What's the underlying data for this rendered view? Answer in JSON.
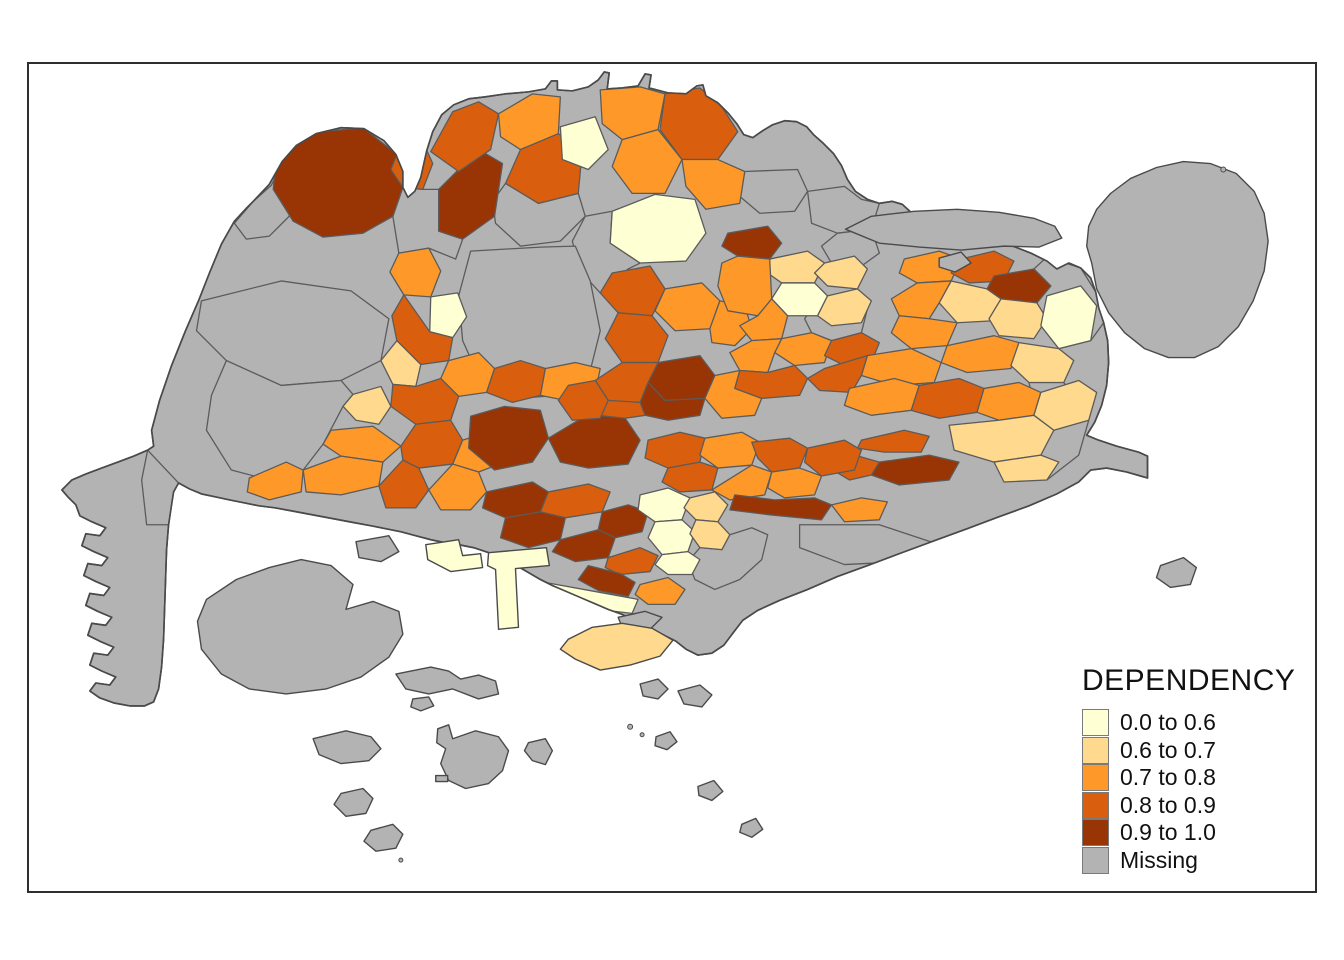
{
  "legend": {
    "title": "DEPENDENCY",
    "items": [
      {
        "label": "0.0 to 0.6",
        "key": "c0",
        "color": "#FFFFD4"
      },
      {
        "label": "0.6 to 0.7",
        "key": "c1",
        "color": "#FED98E"
      },
      {
        "label": "0.7 to 0.8",
        "key": "c2",
        "color": "#FE9929"
      },
      {
        "label": "0.8 to 0.9",
        "key": "c3",
        "color": "#D95F0E"
      },
      {
        "label": "0.9 to 1.0",
        "key": "c4",
        "color": "#993404"
      },
      {
        "label": "Missing",
        "key": "missing",
        "color": "#B3B3B3"
      }
    ]
  },
  "map": {
    "view_box": "27 62 1290 831",
    "colors": {
      "c0": "#FFFFD4",
      "c1": "#FED98E",
      "c2": "#FE9929",
      "c3": "#D95F0E",
      "c4": "#993404",
      "missing": "#B3B3B3",
      "border": "#5B5B5B",
      "coast": "#4A4A4A",
      "water": "#FFFFFF"
    },
    "main_island": "252,200 268,183 281,160 295,144 315,132 340,126 363,127 383,139 395,153 402,170 402,186 407,196 414,190 420,176 426,149 432,130 441,113 453,103 468,97 485,95 505,92 528,90 545,87 551,79 557,79 557,88 572,89 588,85 598,78 604,70 609,71 607,87 622,86 638,84 645,72 651,73 649,86 668,91 686,92 697,84 703,83 706,94 718,101 728,111 737,122 744,133 753,136 763,129 773,123 785,119 797,120 807,125 814,133 823,141 834,152 842,164 848,178 856,190 868,198 880,202 893,200 903,203 916,215 930,222 946,227 962,232 978,236 996,240 1014,245 1032,252 1048,260 1058,268 1070,262 1082,267 1092,277 1097,291 1100,307 1105,322 1109,340 1110,362 1108,385 1103,405 1096,422 1088,435 1100,440 1118,446 1140,452 1149,456 1149,478 1128,472 1108,468 1092,470 1080,482 1058,494 1030,506 1000,517 968,529 935,541 900,554 868,566 838,577 808,590 780,601 758,611 743,621 733,634 724,646 712,654 698,656 686,650 676,642 662,635 650,629 636,622 622,615 608,610 594,604 580,598 566,592 552,586 540,580 528,573 516,566 502,559 488,553 473,548 458,545 444,543 430,540 415,536 400,532 385,529 370,526 354,523 338,520 322,517 306,514 290,511 274,508 258,506 243,503 228,500 214,497 200,494 188,489 177,483 172,492 170,505 167,525 165,550 164,580 163,610 162,640 160,668 157,690 152,703 143,707 128,707 112,704 98,699 88,692 94,684 108,686 114,678 100,672 88,666 92,654 106,656 112,648 98,642 86,636 90,624 104,626 110,618 96,612 84,606 88,594 102,596 108,588 94,582 82,576 86,564 100,566 106,558 92,552 80,546 84,534 98,536 104,528 90,522 78,516 74,505 66,497 60,490 70,480 84,474 100,468 116,462 132,456 146,450 152,446 150,430 158,400 170,365 184,330 197,300 208,272 220,243 233,220 245,207",
    "zones": [
      {
        "k": "missing",
        "p": "200,300 280,280 350,290 388,318 380,360 340,380 280,385 225,360 195,330"
      },
      {
        "k": "missing",
        "p": "225,360 280,385 340,380 352,394 342,406 322,444 302,470 268,480 230,470 205,430 210,395"
      },
      {
        "k": "missing",
        "p": "233,222 252,200 270,184 281,162 292,175 288,215 268,235 245,238"
      },
      {
        "k": "missing",
        "p": "392,215 402,186 422,188 438,188 438,230 462,238 455,258 428,247 398,252"
      },
      {
        "k": "missing",
        "p": "505,182 538,202 578,192 585,215 560,240 520,245 495,222 492,200"
      },
      {
        "k": "missing",
        "p": "585,215 612,210 610,242 640,262 628,268 600,292 580,270 572,240"
      },
      {
        "k": "missing",
        "p": "470,250 540,246 575,245 590,280 600,330 590,370 560,395 515,398 480,380 462,340 458,295"
      },
      {
        "k": "missing",
        "p": "745,170 798,168 808,190 795,210 760,212 740,195"
      },
      {
        "k": "missing",
        "p": "808,190 845,185 862,198 880,202 872,228 838,232 812,222"
      },
      {
        "k": "missing",
        "p": "838,232 872,228 880,252 858,268 832,262 822,245"
      },
      {
        "k": "missing",
        "p": "815,305 848,298 868,308 862,332 832,340 812,332 805,318"
      },
      {
        "k": "missing",
        "p": "1048,256 1082,267 1097,291 1105,322 1092,340 1060,348 1042,325 1038,302 1052,285 1035,268"
      },
      {
        "k": "missing",
        "p": "1065,382 1090,420 1080,455 1048,480 1030,470 1042,430 1030,382"
      },
      {
        "k": "missing",
        "p": "700,548 722,550 730,535 752,528 768,535 762,560 740,580 715,590 695,580 688,562"
      },
      {
        "k": "missing",
        "p": "800,525 880,525 940,545 905,562 845,565 800,548"
      },
      {
        "k": "missing",
        "p": "146,450 177,483 172,492 167,525 145,525 140,480"
      },
      {
        "k": "c4",
        "p": "275,152 310,131 362,126 395,152 402,186 392,215 362,232 322,236 292,220 272,188"
      },
      {
        "k": "c3",
        "p": "398,148 422,140 432,162 422,188 402,186 390,168"
      },
      {
        "k": "c4",
        "p": "438,188 478,148 502,162 494,215 462,238 438,230"
      },
      {
        "k": "c3",
        "p": "430,150 452,110 478,100 498,112 490,148 458,170"
      },
      {
        "k": "c2",
        "p": "498,112 532,92 560,95 558,132 520,148 500,135"
      },
      {
        "k": "c3",
        "p": "520,148 558,132 582,148 578,192 538,202 505,182"
      },
      {
        "k": "c0",
        "p": "560,125 595,115 608,148 588,168 562,158"
      },
      {
        "k": "c2",
        "p": "600,88 640,85 665,92 658,128 622,138 602,122"
      },
      {
        "k": "c3",
        "p": "665,92 700,86 722,105 738,130 718,158 682,158 660,128"
      },
      {
        "k": "c2",
        "p": "622,138 658,128 682,158 665,192 632,192 612,165"
      },
      {
        "k": "c0",
        "p": "612,210 655,193 695,198 706,232 686,260 640,262 610,242"
      },
      {
        "k": "c2",
        "p": "682,158 718,158 745,170 740,202 706,208 686,185"
      },
      {
        "k": "c2",
        "p": "398,252 428,247 440,270 430,296 403,294 389,271"
      },
      {
        "k": "c0",
        "p": "430,296 457,292 466,316 452,337 429,331"
      },
      {
        "k": "c3",
        "p": "403,294 429,331 452,337 448,360 420,364 396,340 391,315"
      },
      {
        "k": "c1",
        "p": "396,340 420,364 415,386 392,384 380,360"
      },
      {
        "k": "c2",
        "p": "448,360 478,352 494,368 486,392 458,396 440,378"
      },
      {
        "k": "c3",
        "p": "392,384 415,386 440,378 458,396 450,420 415,424 390,406"
      },
      {
        "k": "c1",
        "p": "352,394 380,386 390,406 378,424 355,420 342,406"
      },
      {
        "k": "c2",
        "p": "330,430 372,426 400,446 382,462 340,456 322,444"
      },
      {
        "k": "c3",
        "p": "400,446 415,424 450,420 462,440 452,464 418,468 402,460"
      },
      {
        "k": "c2",
        "p": "452,464 462,440 488,432 508,440 504,462 478,472"
      },
      {
        "k": "c2",
        "p": "248,478 285,462 302,470 300,492 268,500 246,492"
      },
      {
        "k": "c2",
        "p": "302,470 340,456 382,462 378,486 340,495 305,492"
      },
      {
        "k": "c3",
        "p": "378,486 402,460 418,468 428,490 415,508 385,508"
      },
      {
        "k": "c2",
        "p": "428,490 452,464 478,472 486,492 470,510 440,510"
      },
      {
        "k": "c3",
        "p": "486,392 494,368 520,360 545,368 540,395 512,402"
      },
      {
        "k": "c2",
        "p": "540,395 545,368 575,362 600,368 595,392 565,400"
      },
      {
        "k": "c4",
        "p": "470,416 504,406 540,410 548,438 532,462 494,470 468,448"
      },
      {
        "k": "c4",
        "p": "548,438 588,414 625,418 640,440 628,464 588,468 560,462"
      },
      {
        "k": "c3",
        "p": "595,392 625,388 648,396 645,415 625,418 588,414 585,400"
      },
      {
        "k": "c4",
        "p": "486,492 532,482 548,492 540,512 505,518 482,508"
      },
      {
        "k": "c3",
        "p": "548,492 588,484 610,492 602,512 565,518 540,512"
      },
      {
        "k": "c4",
        "p": "505,518 540,512 565,518 560,540 528,548 500,538"
      },
      {
        "k": "c4",
        "p": "602,512 628,505 648,512 642,532 615,538 598,530"
      },
      {
        "k": "c4",
        "p": "560,540 598,530 615,538 608,558 575,562 552,552"
      },
      {
        "k": "c3",
        "p": "608,558 640,548 658,556 650,572 620,575 605,568"
      },
      {
        "k": "c3",
        "p": "612,272 650,265 665,288 652,315 618,312 600,292"
      },
      {
        "k": "c2",
        "p": "665,288 702,282 720,300 710,328 675,330 655,310"
      },
      {
        "k": "c2",
        "p": "710,328 720,300 745,305 752,328 735,345 712,342"
      },
      {
        "k": "c3",
        "p": "618,312 652,315 668,335 658,362 622,362 605,338"
      },
      {
        "k": "c4",
        "p": "658,362 700,355 715,375 705,398 665,400 648,382"
      },
      {
        "k": "c3",
        "p": "622,362 658,362 648,382 640,402 608,400 595,380"
      },
      {
        "k": "c4",
        "p": "640,402 648,382 665,400 705,398 700,415 668,420 645,415"
      },
      {
        "k": "c3",
        "p": "595,380 608,400 600,418 572,420 558,400 568,385"
      },
      {
        "k": "c2",
        "p": "715,375 740,370 735,388 762,398 755,415 722,418 705,398"
      },
      {
        "k": "c4",
        "p": "728,232 768,225 782,242 770,258 738,255 722,245"
      },
      {
        "k": "c1",
        "p": "770,258 808,250 825,262 815,282 782,282 765,270"
      },
      {
        "k": "c0",
        "p": "782,282 815,282 828,295 818,315 788,315 772,298"
      },
      {
        "k": "c1",
        "p": "825,262 855,255 868,268 858,288 828,285 815,272"
      },
      {
        "k": "c2",
        "p": "738,255 770,258 772,298 758,315 728,310 718,285 722,262"
      },
      {
        "k": "c2",
        "p": "758,315 772,298 788,315 782,338 752,340 740,325"
      },
      {
        "k": "c1",
        "p": "818,315 828,295 858,288 872,300 862,322 832,325"
      },
      {
        "k": "c2",
        "p": "782,338 812,332 832,340 825,362 795,365 775,352"
      },
      {
        "k": "c2",
        "p": "752,340 782,338 775,352 768,372 740,370 730,352"
      },
      {
        "k": "c3",
        "p": "832,340 862,332 880,342 872,362 845,365 825,355"
      },
      {
        "k": "c3",
        "p": "740,370 768,372 795,365 808,378 800,395 762,398 735,388"
      },
      {
        "k": "c2",
        "p": "905,258 940,250 962,258 952,280 918,282 900,272"
      },
      {
        "k": "c3",
        "p": "962,258 995,250 1015,260 1005,280 970,282 952,272"
      },
      {
        "k": "c1",
        "p": "952,280 988,288 1002,298 995,320 958,322 940,302"
      },
      {
        "k": "c4",
        "p": "995,275 1035,268 1052,285 1038,302 1002,298 988,288"
      },
      {
        "k": "c1",
        "p": "1002,298 1038,302 1048,318 1035,338 1000,335 990,318"
      },
      {
        "k": "c0",
        "p": "1048,295 1082,285 1098,305 1092,340 1060,348 1042,325"
      },
      {
        "k": "c2",
        "p": "918,282 952,280 940,302 930,318 900,315 892,298"
      },
      {
        "k": "c2",
        "p": "900,315 930,318 958,322 948,345 912,348 892,332"
      },
      {
        "k": "c2",
        "p": "948,345 995,335 1020,342 1012,368 968,372 942,362"
      },
      {
        "k": "c1",
        "p": "1020,342 1060,348 1075,360 1065,382 1030,382 1012,365"
      },
      {
        "k": "c2",
        "p": "868,355 912,348 942,362 935,382 895,385 862,375"
      },
      {
        "k": "c3",
        "p": "825,368 868,355 862,375 852,392 820,390 808,378"
      },
      {
        "k": "c2",
        "p": "850,388 895,378 920,385 912,410 872,415 845,405"
      },
      {
        "k": "c3",
        "p": "920,385 960,378 985,388 978,412 940,418 912,410"
      },
      {
        "k": "c2",
        "p": "985,388 1020,382 1042,392 1035,415 1000,420 978,412"
      },
      {
        "k": "c1",
        "p": "1042,392 1080,380 1098,392 1090,420 1055,430 1035,415"
      },
      {
        "k": "c1",
        "p": "950,425 1000,420 1035,415 1055,430 1042,455 995,462 955,450"
      },
      {
        "k": "c3",
        "p": "862,440 905,430 930,436 922,452 885,452 858,448"
      },
      {
        "k": "c4",
        "p": "880,462 930,455 960,462 950,480 900,485 872,475"
      },
      {
        "k": "c3",
        "p": "845,452 880,462 872,475 850,480 830,468 828,455"
      },
      {
        "k": "c1",
        "p": "995,462 1042,455 1060,462 1048,480 1005,482"
      },
      {
        "k": "c3",
        "p": "648,440 680,432 705,438 700,462 668,468 645,458"
      },
      {
        "k": "c2",
        "p": "705,438 742,432 760,442 752,465 718,468 700,455"
      },
      {
        "k": "c3",
        "p": "668,468 700,462 718,468 712,490 680,492 662,482"
      },
      {
        "k": "c2",
        "p": "712,490 752,465 772,472 765,495 730,500"
      },
      {
        "k": "c3",
        "p": "752,442 790,438 808,448 800,468 772,472 758,458"
      },
      {
        "k": "c2",
        "p": "772,472 800,468 822,476 815,495 785,498 768,488"
      },
      {
        "k": "c3",
        "p": "808,448 845,440 862,450 855,470 822,476 805,462"
      },
      {
        "k": "c4",
        "p": "735,495 775,500 815,498 832,505 822,520 770,515 730,510"
      },
      {
        "k": "c2",
        "p": "832,505 862,498 888,502 880,520 845,522"
      },
      {
        "k": "c0",
        "p": "640,495 668,488 690,498 682,520 655,522 638,510"
      },
      {
        "k": "c1",
        "p": "690,498 715,492 728,505 718,522 696,520 684,508"
      },
      {
        "k": "c0",
        "p": "655,522 682,520 695,532 688,552 662,555 648,538"
      },
      {
        "k": "c1",
        "p": "696,520 718,522 730,535 722,550 700,548 690,534"
      },
      {
        "k": "c0",
        "p": "662,555 688,552 700,560 692,575 668,575 655,565"
      },
      {
        "k": "c0",
        "p": "545,583 600,593 638,600 632,614 580,608 543,598"
      },
      {
        "k": "c4",
        "p": "588,566 620,574 635,583 628,597 598,591 578,580"
      },
      {
        "k": "c2",
        "p": "640,585 668,578 685,590 675,605 648,605 635,595"
      }
    ],
    "islands": [
      {
        "name": "jurong-island",
        "k": "missing",
        "p": "205,600 235,580 268,568 300,560 330,566 352,585 345,610 372,602 398,612 402,635 388,658 360,678 325,690 285,695 248,690 220,675 200,650 196,622"
      },
      {
        "name": "jurong-islet",
        "k": "missing",
        "p": "355,542 388,536 398,552 380,562 358,558"
      },
      {
        "name": "brani",
        "k": "missing",
        "p": "618,618 645,612 662,618 650,630 622,628"
      },
      {
        "name": "ubin",
        "k": "missing",
        "p": "846,228 872,215 915,210 958,208 1000,211 1035,217 1056,225 1063,237 1040,246 1005,245 962,249 920,246 880,242"
      },
      {
        "name": "ketam",
        "k": "missing",
        "p": "940,257 962,251 972,262 956,271 940,266"
      },
      {
        "name": "tekong",
        "k": "missing",
        "p": "1093,262 1088,245 1090,225 1098,208 1112,192 1132,177 1158,166 1185,160 1212,162 1238,172 1256,190 1266,212 1270,240 1266,270 1255,300 1240,326 1220,346 1196,357 1170,357 1146,348 1126,332 1110,312 1098,288"
      },
      {
        "name": "se-islet",
        "k": "missing",
        "p": "1162,566 1185,558 1198,568 1192,585 1172,588 1158,578"
      },
      {
        "name": "south-island",
        "k": "missing",
        "p": "395,675 430,668 448,672 460,680 478,676 495,682 498,695 478,700 452,690 428,695 405,690"
      },
      {
        "name": "south-island",
        "k": "missing",
        "p": "412,700 428,698 433,707 420,712 410,708"
      },
      {
        "name": "south-island",
        "k": "missing",
        "p": "312,740 345,732 370,738 380,750 368,762 340,765 318,756"
      },
      {
        "name": "south-island",
        "k": "missing",
        "p": "437,730 448,726 452,740 475,732 498,738 508,752 502,772 488,785 465,790 448,782 440,765 445,750 436,744"
      },
      {
        "name": "south-island",
        "k": "missing",
        "p": "528,744 545,740 552,752 545,766 532,762 524,752"
      },
      {
        "name": "south-island",
        "k": "missing",
        "p": "340,795 362,790 372,800 365,815 345,818 333,806"
      },
      {
        "name": "south-island",
        "k": "missing",
        "p": "370,832 392,826 402,836 395,850 375,853 363,843"
      },
      {
        "name": "south-island",
        "k": "missing",
        "p": "435,777 447,777 447,783 435,783"
      },
      {
        "name": "south-island",
        "k": "missing",
        "p": "640,685 658,680 668,690 658,700 643,697"
      },
      {
        "name": "south-island",
        "k": "missing",
        "p": "678,692 700,686 712,696 702,708 684,705"
      },
      {
        "name": "south-island",
        "k": "missing",
        "p": "656,738 670,733 677,743 667,751 655,747"
      },
      {
        "name": "south-island",
        "k": "missing",
        "p": "698,788 714,782 723,793 712,802 699,797"
      },
      {
        "name": "south-island",
        "k": "missing",
        "p": "742,826 756,820 763,831 752,839 740,834"
      }
    ],
    "islets": [
      {
        "cx": 1225,
        "cy": 168,
        "r": 2.5
      },
      {
        "cx": 630,
        "cy": 728,
        "r": 2.5
      },
      {
        "cx": 642,
        "cy": 736,
        "r": 2
      },
      {
        "cx": 400,
        "cy": 862,
        "r": 2
      }
    ],
    "overlays": [
      {
        "name": "port-pier-west",
        "k": "c0",
        "p": "425,545 458,540 462,556 480,554 482,568 450,572 427,560"
      },
      {
        "name": "port-pier-main",
        "k": "c0",
        "p": "488,553 546,548 549,566 515,569 518,628 498,630 495,570 487,566"
      },
      {
        "name": "sentosa",
        "k": "c1",
        "p": "568,640 592,628 622,624 652,629 673,641 660,657 630,666 600,671 575,660 560,650"
      }
    ]
  }
}
